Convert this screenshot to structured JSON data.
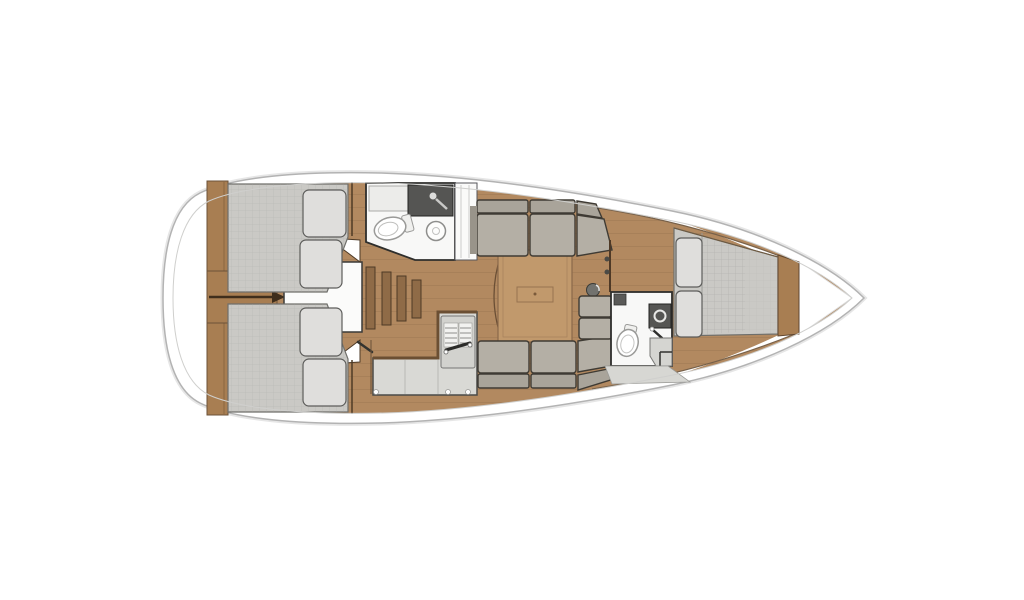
{
  "boat": {
    "type": "sailboat-deck-plan",
    "orientation": "bow-right",
    "areas": [
      {
        "id": "stern-platform",
        "kind": "transom"
      },
      {
        "id": "aft-cabin-port",
        "kind": "double-berth-cabin",
        "pillows": 2
      },
      {
        "id": "aft-cabin-starboard",
        "kind": "double-berth-cabin",
        "pillows": 2
      },
      {
        "id": "aft-head",
        "kind": "bathroom",
        "fixtures": [
          "toilet",
          "sink-counter",
          "round-basin",
          "shower-tray"
        ]
      },
      {
        "id": "galley",
        "kind": "kitchen",
        "fixtures": [
          "l-counter",
          "stove",
          "fridge"
        ]
      },
      {
        "id": "companionway",
        "kind": "stairs",
        "steps": 4
      },
      {
        "id": "saloon",
        "kind": "living-area",
        "furniture": [
          "table",
          "sofa-port",
          "sofa-starboard",
          "l-seat",
          "stool"
        ]
      },
      {
        "id": "forward-head",
        "kind": "bathroom",
        "fixtures": [
          "toilet",
          "vanity"
        ]
      },
      {
        "id": "forward-cabin",
        "kind": "v-berth-cabin",
        "pillows": 2
      },
      {
        "id": "bow-locker",
        "kind": "anchor-locker"
      }
    ]
  },
  "palette": {
    "hull_fill": "#ffffff",
    "hull_line": "#b3b3b3",
    "deck_line": "#cfcfcd",
    "wood": "#b28960",
    "bulkhead": "#a87e52",
    "wood_dark": "#6b5138",
    "table": "#c1996c",
    "mattress": "#cac9c5",
    "pillow": "#dfdedc",
    "cushion": "#b4afa5",
    "cushion_back": "#a9a49a",
    "counter": "#d9d9d5",
    "fixture": "#555553",
    "room": "#f8f8f7",
    "step": "#d5d5d1",
    "outline": "#3a3a38"
  }
}
